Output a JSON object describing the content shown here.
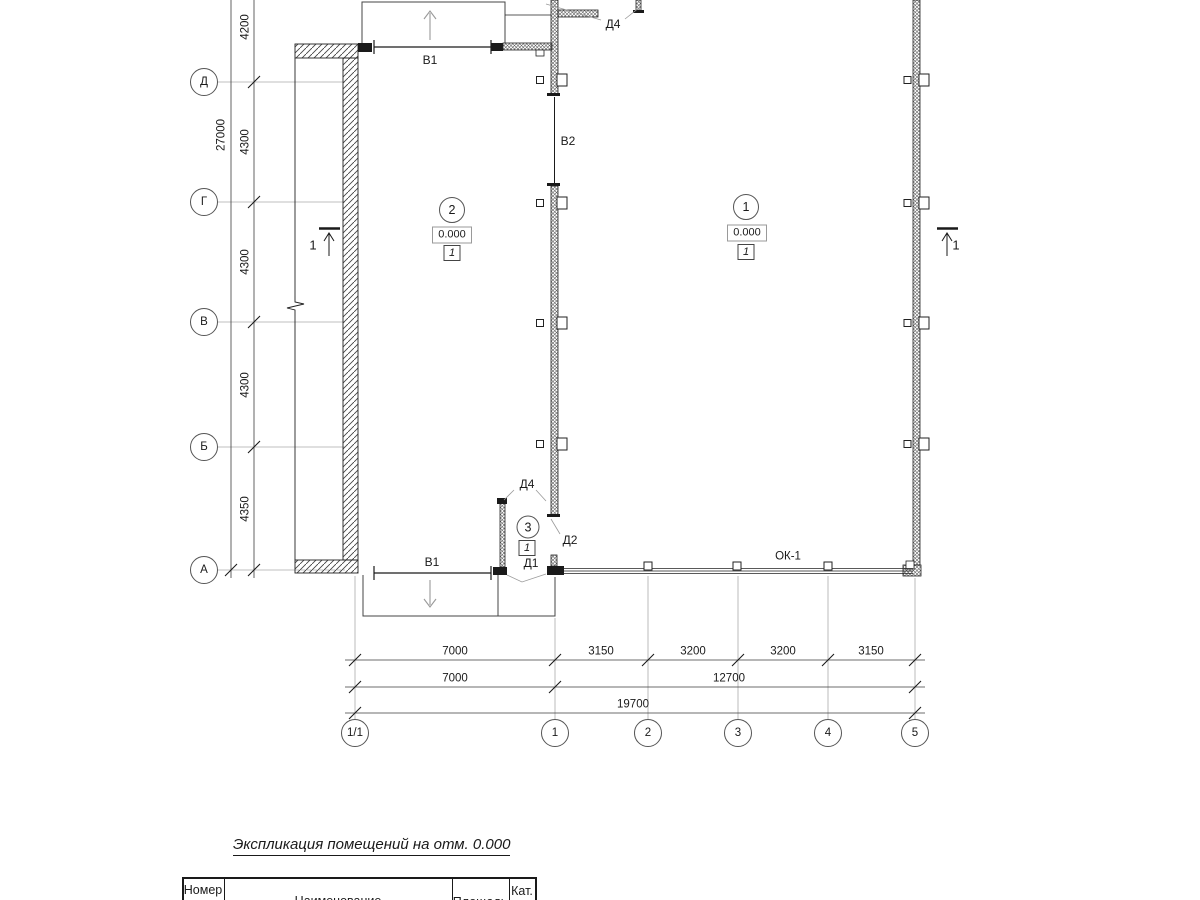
{
  "drawing": {
    "kind": "architectural floor plan, elevation 0.000"
  },
  "grid": {
    "rows": [
      "Д",
      "Г",
      "В",
      "Б",
      "А"
    ],
    "cols": [
      "1/1",
      "1",
      "2",
      "3",
      "4",
      "5"
    ]
  },
  "dims": {
    "left": {
      "total": "27000",
      "segments": [
        "4200",
        "4300",
        "4300",
        "4300",
        "4350"
      ]
    },
    "bottom": {
      "row1": [
        "7000",
        "3150",
        "3200",
        "3200",
        "3150"
      ],
      "row2": [
        "7000",
        "12700"
      ],
      "row3": [
        "19700"
      ]
    }
  },
  "rooms": [
    {
      "number": "2",
      "elevation": "0.000",
      "type_mark": "1"
    },
    {
      "number": "1",
      "elevation": "0.000",
      "type_mark": "1"
    },
    {
      "number": "3",
      "type_mark": "1"
    }
  ],
  "openings": {
    "gate_top": "В1",
    "gate_bottom": "В1",
    "gate_mid": "В2",
    "door_entry_top": "Д4",
    "door_room3_top": "Д4",
    "door_room3_side": "Д2",
    "door_room3_out": "Д1",
    "window_band": "ОК-1"
  },
  "sections": {
    "left": "1",
    "right": "1"
  },
  "schedule": {
    "title": "Экспликация помещений на отм. 0.000",
    "headers": [
      "Номер",
      "Наименование",
      "Площадь",
      "Кат."
    ]
  }
}
